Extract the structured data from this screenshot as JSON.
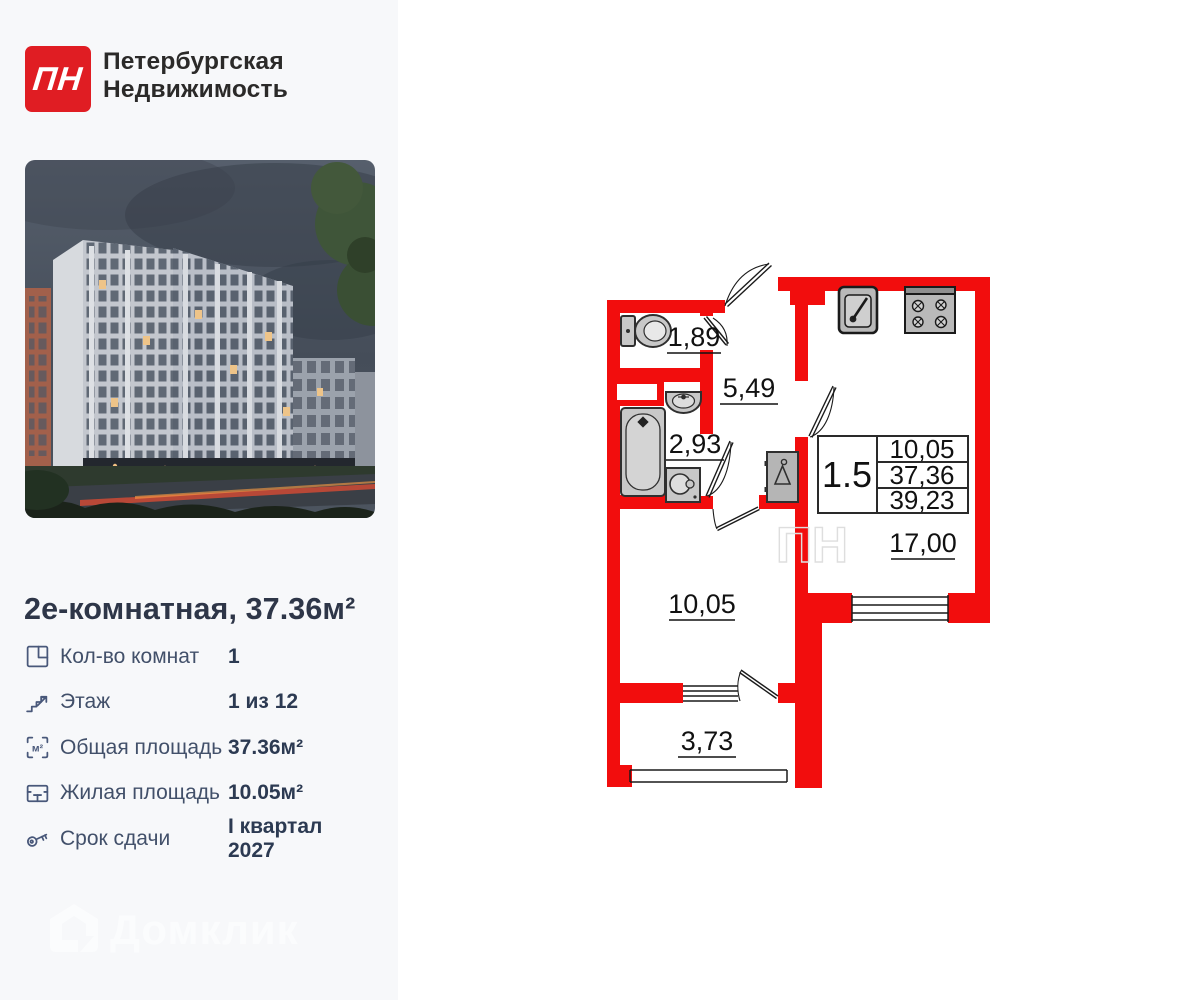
{
  "brand": {
    "monogram": "ПН",
    "name_line1": "Петербургская",
    "name_line2": "Недвижимость",
    "logo_color": "#e01d23"
  },
  "listing": {
    "title": "2е-комнатная, 37.36м²",
    "specs": [
      {
        "icon": "rooms-count-icon",
        "label": "Кол-во комнат",
        "value": "1"
      },
      {
        "icon": "floor-icon",
        "label": "Этаж",
        "value": "1 из 12"
      },
      {
        "icon": "total-area-icon",
        "label": "Общая площадь",
        "value": "37.36м²"
      },
      {
        "icon": "living-area-icon",
        "label": "Жилая площадь",
        "value": "10.05м²"
      },
      {
        "icon": "key-icon",
        "label": "Срок сдачи",
        "value": "I квартал 2027"
      }
    ]
  },
  "icons": {
    "area_glyph": "м²"
  },
  "floorplan": {
    "wall_color": "#f20d0d",
    "rooms": {
      "wc": "1,89",
      "hallway": "5,49",
      "bathroom": "2,93",
      "bedroom": "10,05",
      "balcony": "3,73",
      "kitchen_living": "17,00"
    },
    "info_table": {
      "apartment_type": "1.5",
      "living_area": "10,05",
      "total_area": "37,36",
      "total_with_balcony": "39,23"
    },
    "plan_watermark": "ПН"
  },
  "watermark": {
    "text": "Домклик"
  }
}
